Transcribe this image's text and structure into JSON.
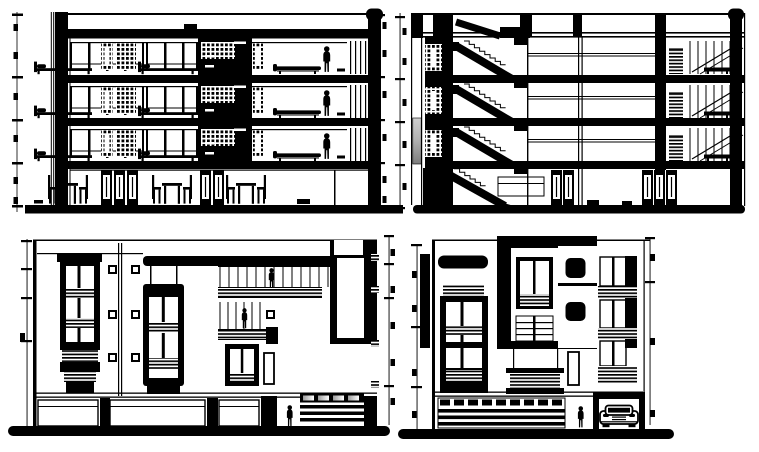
{
  "page": {
    "colors": {
      "paper": "#ffffff",
      "ink": "#000000",
      "g1": "#cfcfcf",
      "g2": "#b3b3b3",
      "g3": "#7d7d7d",
      "smudge": "#9c9c9c"
    }
  },
  "drawing": {
    "kind": "black-and-white architectural CAD sheet, no text labels",
    "views": [
      {
        "id": "cross-section",
        "position": "top-left",
        "levels": 4,
        "label": "Cross-section through rooms: three upper bedroom levels with beds, lounges and standing figures, hatched screen walls, ground floor dining tables and chairs"
      },
      {
        "id": "stair-section",
        "position": "top-right",
        "levels": 4,
        "label": "Cross-section through staircase: dog-leg stair flights with sawtooth steps, hatched shaft windows, grey highlighted wall panel, glazed bays at right"
      },
      {
        "id": "front-elevation",
        "position": "bottom-left",
        "levels": 3,
        "label": "Front elevation: dark window towers with louvre bands, balcony figures, storefront openings and slatted garage door"
      },
      {
        "id": "side-elevation",
        "position": "bottom-right",
        "levels": 3,
        "label": "Side elevation: dark framed window towers, slatted entrance gate, standing figure and car in garage opening"
      }
    ],
    "figures": {
      "people": 7,
      "cars": 1,
      "beds": 6,
      "dining_tables": 3,
      "lounges": 3
    }
  }
}
